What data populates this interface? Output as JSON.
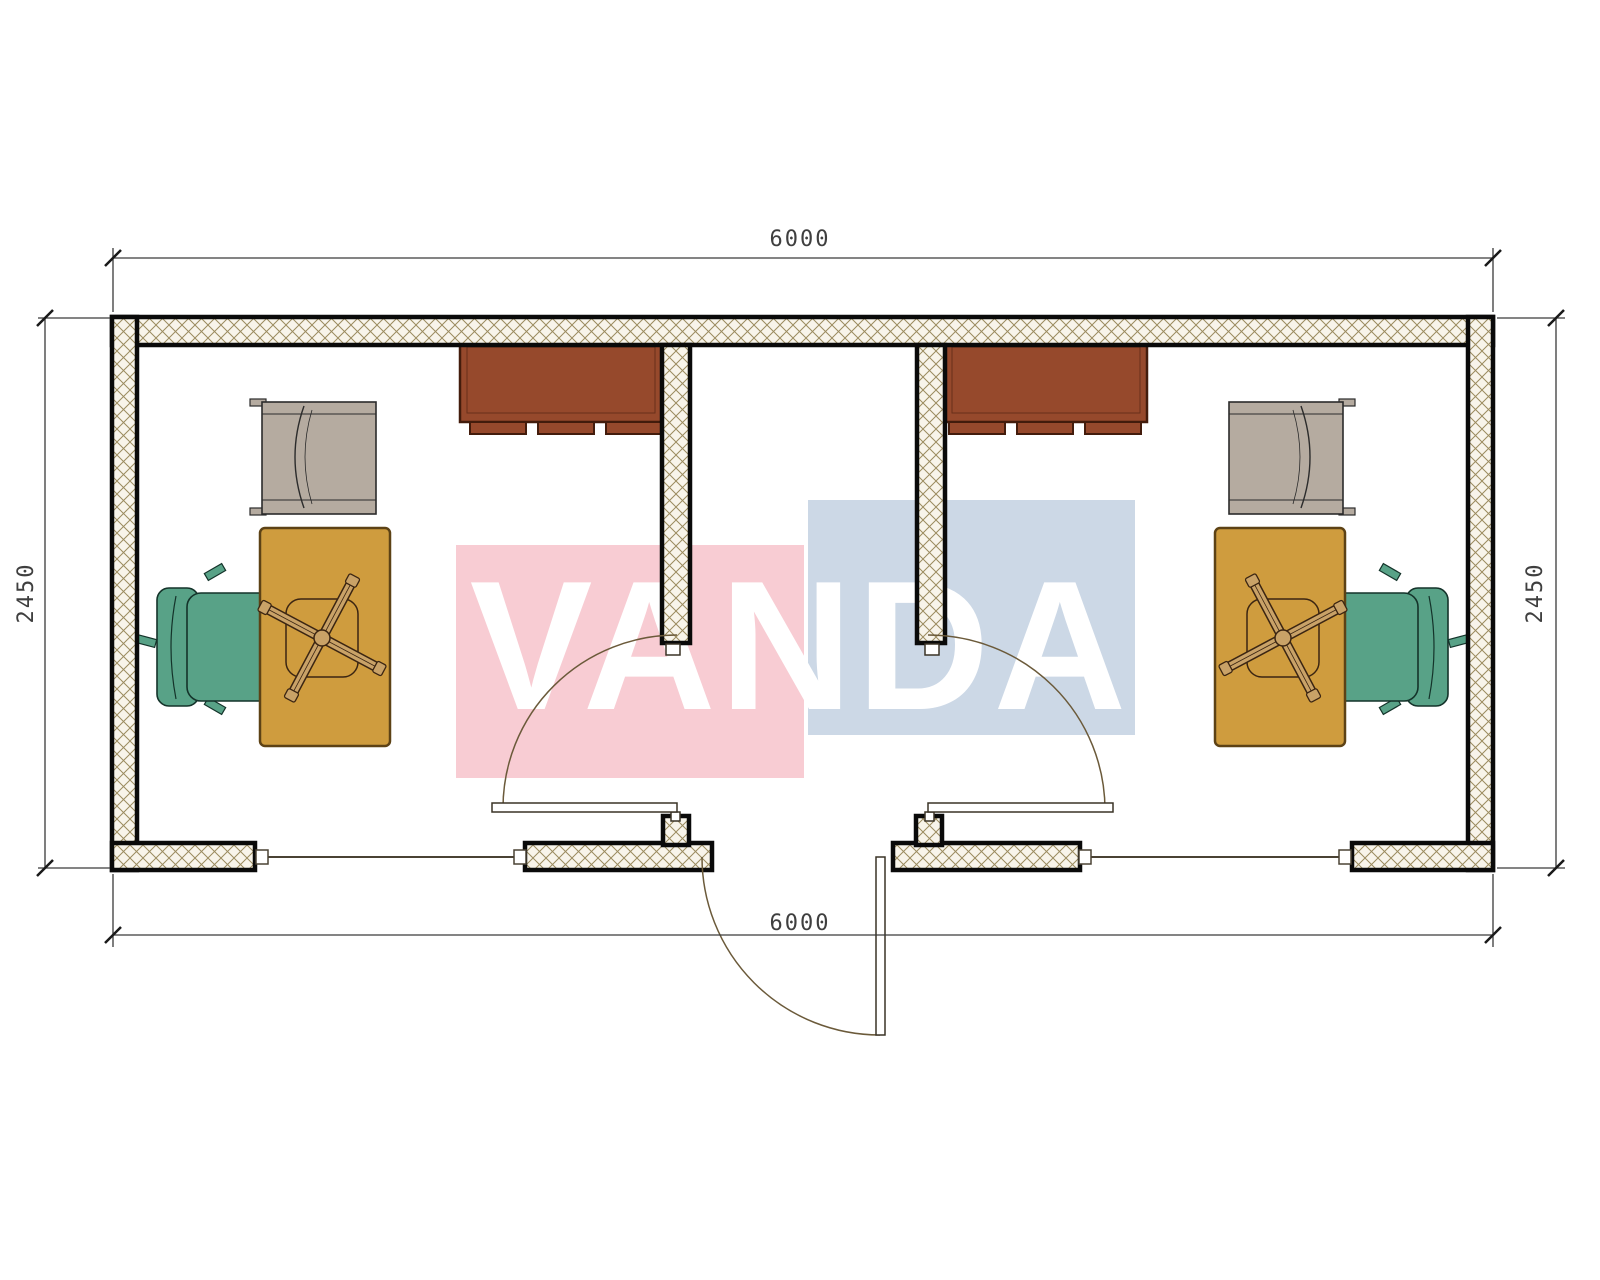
{
  "drawing": {
    "type": "floor-plan",
    "building_width_mm": "6000",
    "building_depth_mm": "2450"
  },
  "dimensions": {
    "top": "6000",
    "bottom": "6000",
    "left": "2450",
    "right": "2450"
  },
  "watermark": {
    "text": "VANDA",
    "pink": "#f8ccd3",
    "blue": "#ccd8e6",
    "text_color": "#ffffff"
  },
  "colors": {
    "wall_line": "#0a0a0a",
    "hatch_line": "#9b8b5e",
    "hatch_bg": "#f8f4ea",
    "room_floor": "#ffffff",
    "dimension_line": "#3a3a3a",
    "dimension_tick": "#1a1a1a",
    "dimension_text": "#3f3f3f",
    "window_line": "#4a4234",
    "window_frame_fill": "#ffffff",
    "door_arc": "#6b5a3a",
    "door_leaf_fill": "#ffffff",
    "door_leaf_line": "#3a3326",
    "cabinet": "#96492c",
    "cabinet_outline": "#431c0c",
    "desk": "#cf9c3e",
    "desk_outline": "#5d4215",
    "armchair": "#b5aba0",
    "armchair_outline": "#2b2b2b",
    "task_chair_base": "#c9a267",
    "task_chair_outline": "#3b2512",
    "exec_chair": "#58a287",
    "exec_chair_outline": "#14332a"
  }
}
